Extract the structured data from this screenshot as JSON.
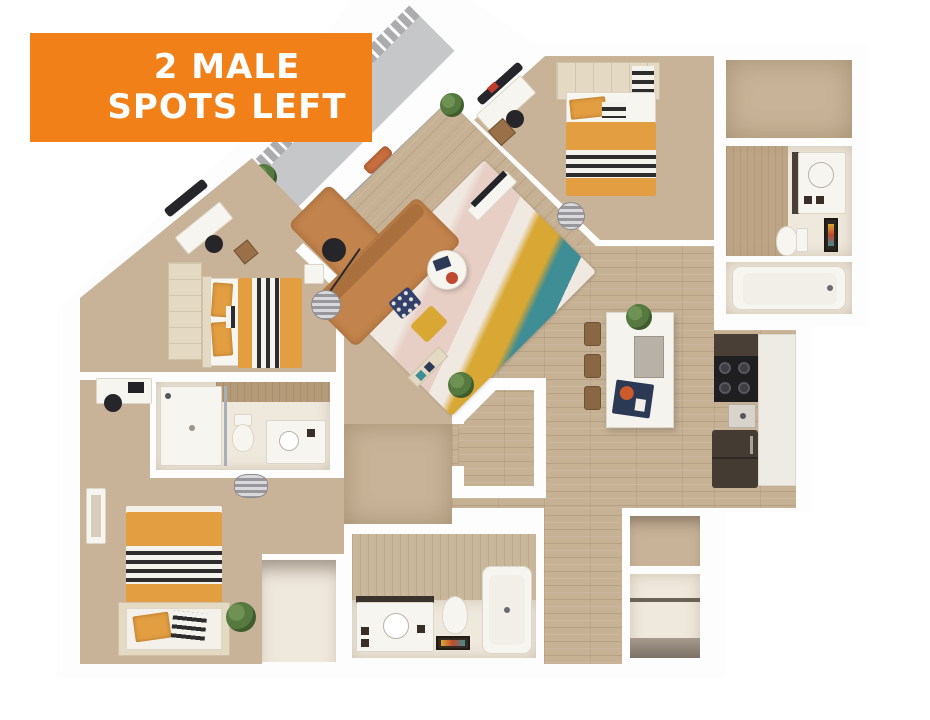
{
  "banner": {
    "line1": "2 MALE",
    "line2": "SPOTS LEFT"
  },
  "palette": {
    "banner_orange": "#F28019",
    "banner_text": "#FFFFFF",
    "wall_white": "#FDFDFD",
    "carpet_tan": "#C8B398",
    "wood_floor": "#C6B194",
    "bath_pale": "#EFE8DC",
    "tile_brown": "#B59A77",
    "duvet_orange": "#E29E41",
    "sofa_caramel": "#C2834C",
    "rug_teal": "#3F8D95",
    "rug_mustard": "#D9A733",
    "curtain_orange": "#C96F3F",
    "cabinet_dark": "#4A3F36",
    "appliance_black": "#1F1F22",
    "plant_green": "#56793F",
    "deck_grey": "#C6C7C9"
  }
}
